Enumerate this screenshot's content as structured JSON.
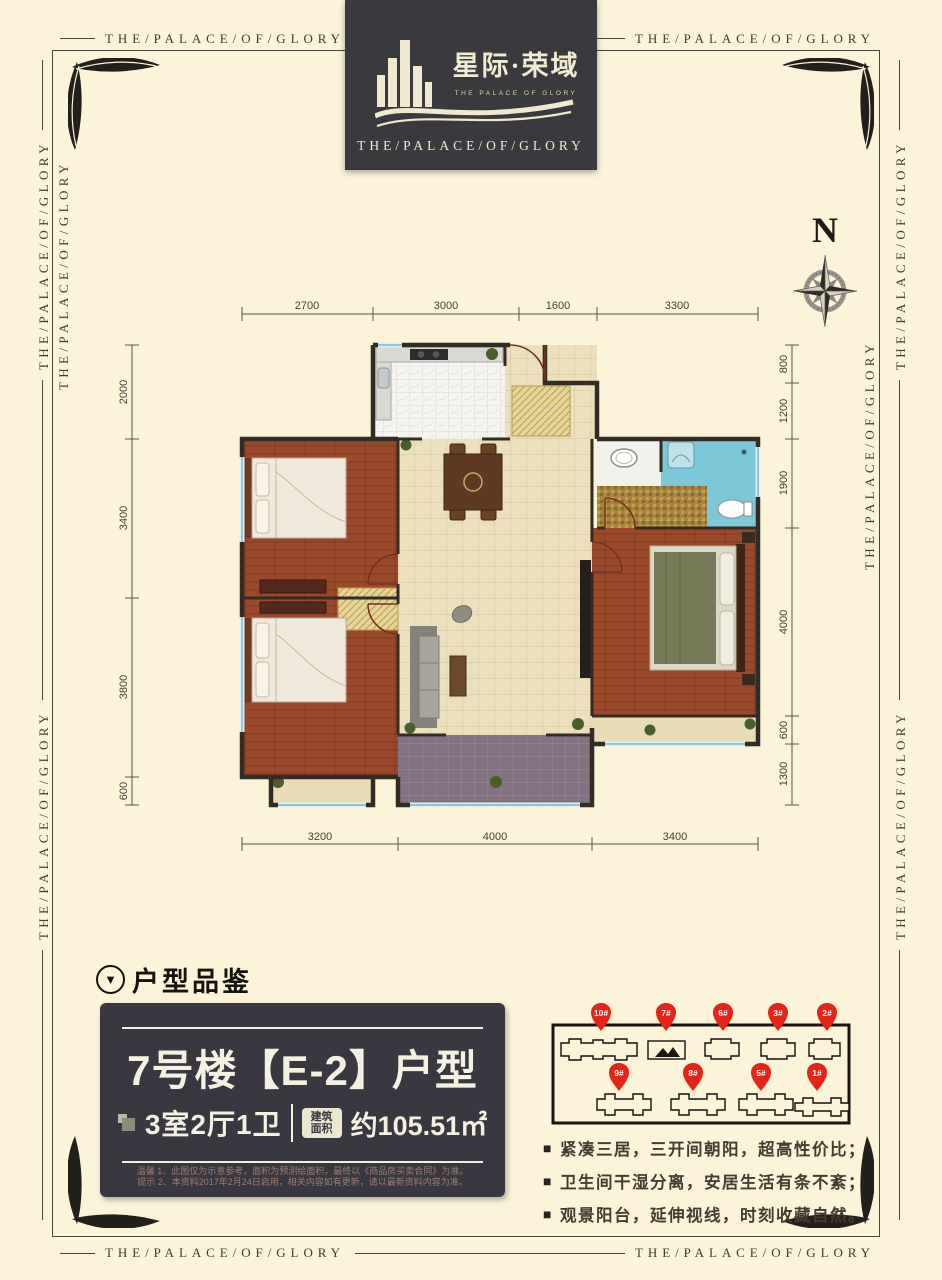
{
  "border": {
    "motto": "THE/PALACE/OF/GLORY"
  },
  "logo": {
    "cn_title": "星际·荣域",
    "en_small": "THE PALACE OF GLORY",
    "en_bottom": "THE/PALACE/OF/GLORY"
  },
  "compass": {
    "label": "N"
  },
  "floorplan": {
    "dims_top": [
      "2700",
      "3000",
      "1600",
      "3300"
    ],
    "dims_bottom": [
      "3200",
      "4000",
      "3400"
    ],
    "dims_left": [
      "2000",
      "3400",
      "3800",
      "600"
    ],
    "dims_right": [
      "800",
      "1200",
      "1900",
      "4000",
      "600",
      "1300"
    ]
  },
  "section": {
    "title": "户型品鉴",
    "marker_icon": "▼"
  },
  "unit_card": {
    "title": "7号楼【E-2】户型",
    "rooms": "3室2厅1卫",
    "area_badge_line1": "建筑",
    "area_badge_line2": "面积",
    "area_value": "约105.51㎡",
    "disclaimer_line1": "温馨  1、此图仅为示意参考，面积为预测绘面积，最终以《商品房买卖合同》为准。",
    "disclaimer_line2": "提示  2、本资料2017年2月24日启用，相关内容如有更新，请以最新资料内容为准。"
  },
  "site_map": {
    "highlighted": "7#",
    "pins": [
      {
        "label": "10#"
      },
      {
        "label": "7#"
      },
      {
        "label": "6#"
      },
      {
        "label": "3#"
      },
      {
        "label": "2#"
      },
      {
        "label": "9#"
      },
      {
        "label": "8#"
      },
      {
        "label": "5#"
      },
      {
        "label": "1#"
      }
    ]
  },
  "selling_points": [
    "紧凑三居，三开间朝阳，超高性价比；",
    "卫生间干湿分离，安居生活有条不紊；",
    "观景阳台，延伸视线，时刻收藏自然。"
  ],
  "icons": {
    "bullet": "■"
  },
  "colors": {
    "page_bg": "#fbf4d9",
    "panel_bg": "#3a393d",
    "cream_text": "#f2eed9",
    "wall": "#332c25",
    "wood_floor": "#9a4a2b",
    "tile_floor": "#ebdfbc",
    "balcony_floor": "#837281",
    "bath_blue": "#7cc8d8",
    "mosaic_gold": "#a8853e",
    "pin_red": "#e42417",
    "disclaimer_text": "#9c7c74"
  }
}
